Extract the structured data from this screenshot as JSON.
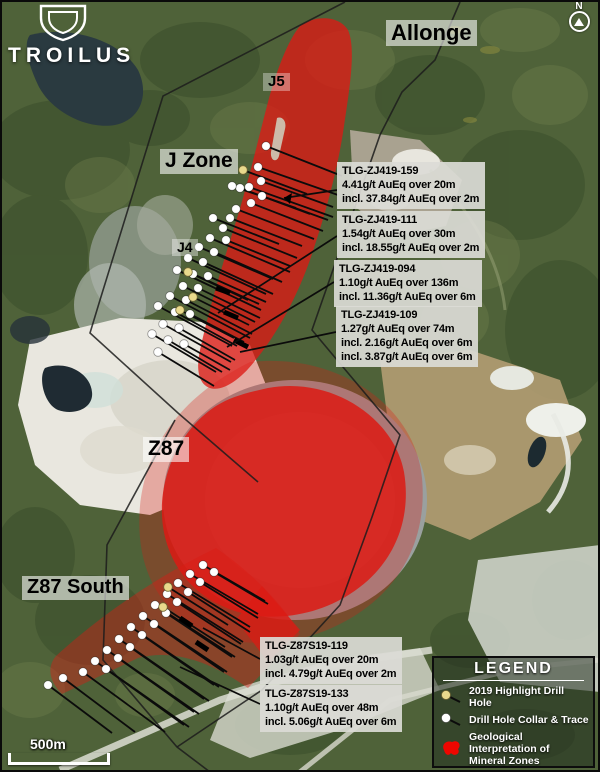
{
  "brand": {
    "name": "TROILUS"
  },
  "north_label": "N",
  "scale_bar": {
    "label": "500m"
  },
  "zone_labels": {
    "allonge": "Allonge",
    "j5": "J5",
    "j_zone": "J Zone",
    "j4": "J4",
    "z87": "Z87",
    "z87_south": "Z87 South"
  },
  "annotations": [
    {
      "id": "TLG-ZJ419-159",
      "lines": [
        "4.41g/t AuEq over 20m",
        "incl. 37.84g/t AuEq over 2m"
      ]
    },
    {
      "id": "TLG-ZJ419-111",
      "lines": [
        "1.54g/t AuEq over 30m",
        "incl. 18.55g/t AuEq over 2m"
      ]
    },
    {
      "id": "TLG-ZJ419-094",
      "lines": [
        "1.10g/t AuEq over 136m",
        "incl. 11.36g/t AuEq over 6m"
      ]
    },
    {
      "id": "TLG-ZJ419-109",
      "lines": [
        "1.27g/t AuEq over 74m",
        "incl. 2.16g/t AuEq over 6m",
        "incl. 3.87g/t AuEq over 6m"
      ]
    },
    {
      "id": "TLG-Z87S19-119",
      "lines": [
        "1.03g/t AuEq over 20m",
        "incl. 4.79g/t AuEq over 2m"
      ]
    },
    {
      "id": "TLG-Z87S19-133",
      "lines": [
        "1.10g/t AuEq over 48m",
        "incl. 5.06g/t AuEq over 6m"
      ]
    }
  ],
  "legend": {
    "title": "LEGEND",
    "items": [
      {
        "label": "2019 Highlight Drill Hole",
        "icon": "highlight-drill-hole-icon"
      },
      {
        "label": "Drill Hole Collar & Trace",
        "icon": "drill-hole-collar-icon"
      },
      {
        "label": "Geological Interpretation of Mineral Zones",
        "icon": "mineral-zone-blob-icon"
      }
    ]
  },
  "colors": {
    "mineral_red": "#DC1A14",
    "legend_red": "#EE0600",
    "highlight_yellow": "#E9D98C",
    "collar_white": "#FFFFFF",
    "trace_black": "#0B0B0B",
    "boundary_black": "#1C1C1C"
  },
  "map": {
    "red_zones": [
      {
        "name": "z87-fringe",
        "path": "M250,362 C340,352 416,408 422,478 C428,544 396,596 340,624 C290,650 224,650 184,620 C148,594 136,552 140,506 C146,448 178,398 250,362 Z",
        "opacity": 0.3
      },
      {
        "name": "j-zone-band",
        "path": "M300,26 C312,16 338,14 348,30 C356,48 350,86 344,126 C338,168 326,212 312,254 C298,296 276,336 254,362 C240,380 222,392 210,388 C198,384 196,368 200,350 C208,314 220,272 234,228 C248,184 258,140 268,102 C276,72 288,40 300,26 Z",
        "opacity": 0.78
      },
      {
        "name": "z87-core",
        "path": "M268,388 C332,376 394,418 404,472 C412,520 394,566 350,594 C310,620 256,624 218,604 C186,588 164,556 162,516 C160,472 182,428 216,406 C232,396 250,392 268,388 Z",
        "opacity": 0.85
      },
      {
        "name": "z87-south-band",
        "path": "M216,548 C248,570 282,602 300,634 L248,688 C214,664 176,648 138,658 L62,694 C50,682 46,668 56,656 C104,612 162,574 216,548 Z",
        "opacity": 0.42
      },
      {
        "name": "z87-south-dark",
        "path": "M262,586 L300,630 L268,662 L236,620 Z",
        "opacity": 0.72
      }
    ],
    "j_notch": {
      "path": "M277,118 C282,116 287,121 285,129 L279,156 C277,163 270,161 271,152 Z",
      "fill": "#cfd3c2",
      "opacity": 0.85
    },
    "boundary_lines": [
      "345,2 163,96 100,300 90,333 178,413 258,482",
      "460,2 435,60 402,92 380,135 312,330 322,342 400,435 372,517 340,605 262,690 177,747",
      "175,420 107,545 103,660 177,747 210,772"
    ],
    "drill_holes": [
      [
        266,
        146,
        76,
        30,
        "w"
      ],
      [
        258,
        167,
        80,
        28,
        "w"
      ],
      [
        261,
        181,
        72,
        26,
        "w"
      ],
      [
        249,
        187,
        84,
        30,
        "w"
      ],
      [
        262,
        196,
        66,
        24,
        "w"
      ],
      [
        240,
        188,
        70,
        26,
        "w"
      ],
      [
        232,
        186,
        64,
        22,
        "w"
      ],
      [
        251,
        203,
        72,
        28,
        "w"
      ],
      [
        236,
        209,
        78,
        30,
        "w"
      ],
      [
        230,
        218,
        72,
        28,
        "w"
      ],
      [
        213,
        218,
        66,
        26,
        "w"
      ],
      [
        223,
        228,
        74,
        30,
        "w"
      ],
      [
        210,
        238,
        80,
        34,
        "w"
      ],
      [
        226,
        240,
        64,
        26,
        "w"
      ],
      [
        199,
        247,
        74,
        32,
        "w"
      ],
      [
        214,
        252,
        68,
        30,
        "w"
      ],
      [
        188,
        258,
        78,
        36,
        "w"
      ],
      [
        203,
        262,
        70,
        32,
        "w"
      ],
      [
        177,
        270,
        84,
        40,
        "w"
      ],
      [
        193,
        274,
        66,
        30,
        "w"
      ],
      [
        208,
        276,
        58,
        26,
        "w"
      ],
      [
        183,
        286,
        72,
        36,
        "w"
      ],
      [
        198,
        288,
        62,
        30,
        "w"
      ],
      [
        170,
        296,
        80,
        42,
        "w"
      ],
      [
        186,
        300,
        66,
        34,
        "w"
      ],
      [
        158,
        306,
        74,
        40,
        "w"
      ],
      [
        175,
        312,
        62,
        34,
        "w"
      ],
      [
        190,
        314,
        54,
        28,
        "w"
      ],
      [
        163,
        324,
        68,
        38,
        "w"
      ],
      [
        179,
        328,
        56,
        32,
        "w"
      ],
      [
        152,
        334,
        64,
        38,
        "w"
      ],
      [
        168,
        340,
        54,
        32,
        "w"
      ],
      [
        184,
        344,
        46,
        26,
        "w"
      ],
      [
        158,
        352,
        56,
        34,
        "w"
      ],
      [
        243,
        170,
        64,
        24,
        "y"
      ],
      [
        188,
        272,
        60,
        28,
        "y"
      ],
      [
        193,
        297,
        56,
        28,
        "y"
      ],
      [
        180,
        310,
        54,
        28,
        "y"
      ],
      [
        203,
        565,
        62,
        36,
        "w"
      ],
      [
        214,
        572,
        54,
        32,
        "w"
      ],
      [
        190,
        574,
        68,
        40,
        "w"
      ],
      [
        200,
        582,
        58,
        36,
        "w"
      ],
      [
        178,
        583,
        72,
        44,
        "w"
      ],
      [
        188,
        592,
        62,
        40,
        "w"
      ],
      [
        167,
        594,
        76,
        48,
        "w"
      ],
      [
        177,
        602,
        64,
        42,
        "w"
      ],
      [
        155,
        605,
        80,
        52,
        "w"
      ],
      [
        166,
        613,
        66,
        44,
        "w"
      ],
      [
        143,
        616,
        84,
        56,
        "w"
      ],
      [
        154,
        624,
        70,
        48,
        "w"
      ],
      [
        131,
        627,
        88,
        60,
        "w"
      ],
      [
        142,
        635,
        72,
        50,
        "w"
      ],
      [
        119,
        639,
        90,
        62,
        "w"
      ],
      [
        130,
        647,
        74,
        52,
        "w"
      ],
      [
        107,
        650,
        92,
        64,
        "w"
      ],
      [
        118,
        658,
        76,
        54,
        "w"
      ],
      [
        95,
        661,
        94,
        66,
        "w"
      ],
      [
        106,
        669,
        78,
        56,
        "w"
      ],
      [
        83,
        672,
        82,
        60,
        "w"
      ],
      [
        63,
        678,
        72,
        54,
        "w"
      ],
      [
        48,
        685,
        64,
        48,
        "w"
      ],
      [
        168,
        587,
        60,
        38,
        "y"
      ],
      [
        163,
        607,
        62,
        40,
        "y"
      ]
    ],
    "intercepts": [
      [
        216,
        288,
        230,
        293
      ],
      [
        224,
        312,
        238,
        318
      ],
      [
        234,
        340,
        248,
        347
      ],
      [
        180,
        618,
        192,
        626
      ],
      [
        196,
        642,
        208,
        650
      ]
    ],
    "leaders": [
      {
        "from": [
          337,
          190
        ],
        "to": [
          284,
          198
        ],
        "arrow": "292,193 290,204 284,198"
      },
      {
        "from": [
          337,
          236
        ],
        "to": [
          218,
          313
        ]
      },
      {
        "from": [
          334,
          282
        ],
        "to": [
          227,
          347
        ]
      },
      {
        "from": [
          336,
          332
        ],
        "to": [
          240,
          352
        ]
      },
      {
        "from": [
          260,
          659
        ],
        "to": [
          203,
          628
        ]
      },
      {
        "from": [
          260,
          704
        ],
        "to": [
          180,
          667
        ]
      }
    ]
  }
}
